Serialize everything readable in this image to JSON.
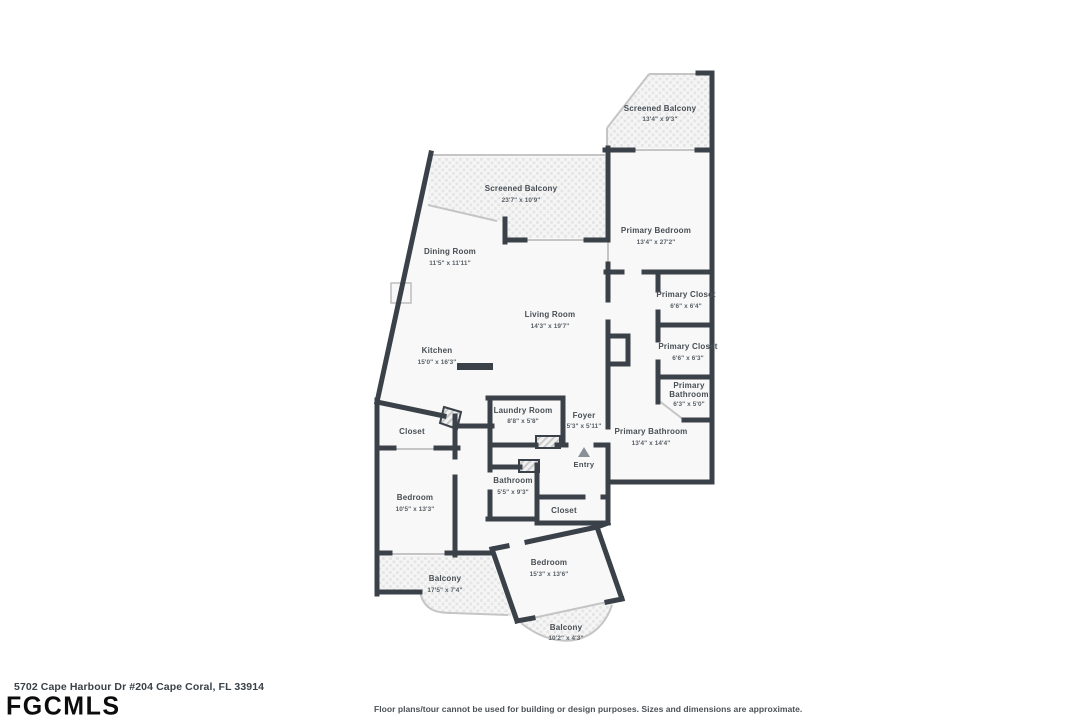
{
  "footer": {
    "address": "5702 Cape Harbour Dr #204 Cape Coral, FL 33914",
    "logo": "FGCMLS",
    "disclaimer": "Floor plans/tour cannot be used for building or design purposes. Sizes and dimensions are approximate."
  },
  "colors": {
    "wall": "#3b4148",
    "room_fill": "#f8f8f8",
    "screen_line": "#c5c5c5",
    "label_text": "#474e54",
    "entry_arrow": "#8a9097"
  },
  "rooms": [
    {
      "name": "Screened Balcony",
      "dims": "13'4\" x 9'3\""
    },
    {
      "name": "Primary Bedroom",
      "dims": "13'4\" x 27'2\""
    },
    {
      "name": "Screened Balcony",
      "dims": "23'7\" x 10'9\""
    },
    {
      "name": "Dining Room",
      "dims": "11'5\" x 11'11\""
    },
    {
      "name": "Living Room",
      "dims": "14'3\" x 19'7\""
    },
    {
      "name": "Kitchen",
      "dims": "15'0\" x 16'3\""
    },
    {
      "name": "Primary Closet",
      "dims": "6'6\" x 6'4\""
    },
    {
      "name": "Primary Closet",
      "dims": "6'6\" x 6'3\""
    },
    {
      "name_lines": [
        "Primary",
        "Bathroom"
      ],
      "dims": "6'3\" x 5'0\""
    },
    {
      "name": "Primary Bathroom",
      "dims": "13'4\" x 14'4\""
    },
    {
      "name": "Laundry Room",
      "dims": "8'8\" x 5'8\""
    },
    {
      "name": "Foyer",
      "dims": "5'3\" x 5'11\""
    },
    {
      "name": "Entry"
    },
    {
      "name": "Closet"
    },
    {
      "name": "Bedroom",
      "dims": "10'5\" x 13'3\""
    },
    {
      "name": "Bathroom",
      "dims": "5'5\" x 9'3\""
    },
    {
      "name": "Closet"
    },
    {
      "name": "Bedroom",
      "dims": "15'3\" x 13'6\""
    },
    {
      "name": "Balcony",
      "dims": "17'5\" x 7'4\""
    },
    {
      "name": "Balcony",
      "dims": "10'2\" x 4'3\""
    }
  ]
}
